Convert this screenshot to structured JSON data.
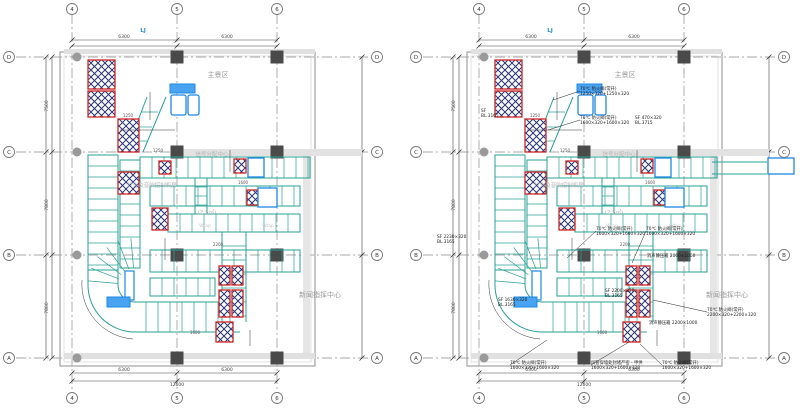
{
  "page": {
    "background": "#ffffff"
  },
  "colors": {
    "duct_teal": "#2aa095",
    "crosshatch_red": "#cc2626",
    "crosshatch_navy": "#27357a",
    "accent_blue": "#1e88e5",
    "column_dark": "#4a4a4a",
    "wall_gray": "#999999",
    "grid_gray": "#8a8a8a",
    "label_gray": "#9a9a9a"
  },
  "grid": {
    "top": [
      "4",
      "5",
      "6"
    ],
    "bottom": [
      "4",
      "5",
      "6"
    ],
    "left": [
      "D",
      "C",
      "B",
      "A"
    ],
    "right": [
      "D",
      "C",
      "B",
      "A"
    ]
  },
  "dims": {
    "top": [
      {
        "x": 124,
        "y": 38,
        "t": "6300"
      },
      {
        "x": 227,
        "y": 38,
        "t": "6300"
      }
    ],
    "bottom": [
      {
        "x": 124,
        "y": 371,
        "t": "6300"
      },
      {
        "x": 227,
        "y": 371,
        "t": "6300"
      },
      {
        "x": 177,
        "y": 386,
        "t": "12600"
      }
    ],
    "left": [
      {
        "x": 48,
        "y": 106,
        "t": "7500"
      },
      {
        "x": 48,
        "y": 205,
        "t": "7800"
      },
      {
        "x": 48,
        "y": 308,
        "t": "7800"
      }
    ],
    "interior": [
      {
        "x": 158,
        "y": 152,
        "t": "1250"
      },
      {
        "x": 128,
        "y": 117,
        "t": "1250"
      },
      {
        "x": 243,
        "y": 184,
        "t": "1600"
      },
      {
        "x": 218,
        "y": 246,
        "t": "2200"
      },
      {
        "x": 195,
        "y": 334,
        "t": "1600"
      }
    ]
  },
  "shared_labels": [
    {
      "x": 218,
      "y": 77,
      "c": "zone",
      "t": "主景区"
    },
    {
      "x": 212,
      "y": 156,
      "c": "faint",
      "t": "信号分配中心"
    },
    {
      "x": 320,
      "y": 297,
      "c": "zone",
      "t": "新闻指挥中心"
    },
    {
      "x": 207,
      "y": 214,
      "c": "faint",
      "t": "(2.5㎡)"
    },
    {
      "x": 143,
      "y": 32,
      "c": "blue",
      "t": "LJ"
    },
    {
      "x": 152,
      "y": 187,
      "c": "faint",
      "t": "灯光及音响控制机房"
    },
    {
      "x": 205,
      "y": 227,
      "c": "faint2",
      "t": "Wtap"
    },
    {
      "x": 268,
      "y": 227,
      "c": "faint2",
      "t": "Wtap"
    }
  ],
  "plans": [
    {
      "name": "plan-left",
      "annotations": []
    },
    {
      "name": "plan-right",
      "annotations": [
        {
          "x": 173,
          "y": 90,
          "lx": 146,
          "ly": 100,
          "t": [
            "70℃ 防火阀(常开)",
            "1250×320+1250×320"
          ]
        },
        {
          "x": 173,
          "y": 119,
          "lx": 141,
          "ly": 130,
          "t": [
            "70℃ 防火阀(常开)",
            "1600×320+1600×320"
          ]
        },
        {
          "x": 228,
          "y": 119,
          "t": [
            "SF 470×320",
            "BL.3715"
          ]
        },
        {
          "x": 74,
          "y": 112,
          "t": [
            "SF",
            "BL.3165"
          ]
        },
        {
          "x": 189,
          "y": 230,
          "lx": 160,
          "ly": 258,
          "t": [
            "70℃ 防火阀(常开)",
            "1600×320+1600×320"
          ]
        },
        {
          "x": 239,
          "y": 230,
          "lx": 225,
          "ly": 263,
          "t": [
            "70℃ 防火阀(常开)",
            "1600×320+1600×320"
          ]
        },
        {
          "x": 240,
          "y": 257,
          "t": [
            "消声静压箱 2000×1000"
          ]
        },
        {
          "x": 198,
          "y": 292,
          "t": [
            "SF 2200×320",
            "BL.3165"
          ]
        },
        {
          "x": 300,
          "y": 311,
          "lx": 246,
          "ly": 300,
          "t": [
            "70℃ 防火阀(常开)",
            "2200×320+2200×320"
          ]
        },
        {
          "x": 242,
          "y": 324,
          "t": [
            "消声静压箱 2200×1000"
          ]
        },
        {
          "x": 103,
          "y": 364,
          "lx": 140,
          "ly": 340,
          "t": [
            "70℃ 防火阀(常开)",
            "1600×320+1600×320"
          ]
        },
        {
          "x": 184,
          "y": 364,
          "lx": 222,
          "ly": 342,
          "t": [
            "风管穿墙处封堵严密 - 甲供",
            "1600×320+1600×320"
          ]
        },
        {
          "x": 255,
          "y": 364,
          "lx": 233,
          "ly": 344,
          "t": [
            "70℃ 防火阀(常开)",
            "1600×320+1600×320"
          ]
        },
        {
          "x": 30,
          "y": 238,
          "t": [
            "SF 2230×320",
            "BL.3165"
          ]
        },
        {
          "x": 91,
          "y": 301,
          "t": [
            "SF 1630×320",
            "BL.3165"
          ]
        }
      ]
    }
  ]
}
